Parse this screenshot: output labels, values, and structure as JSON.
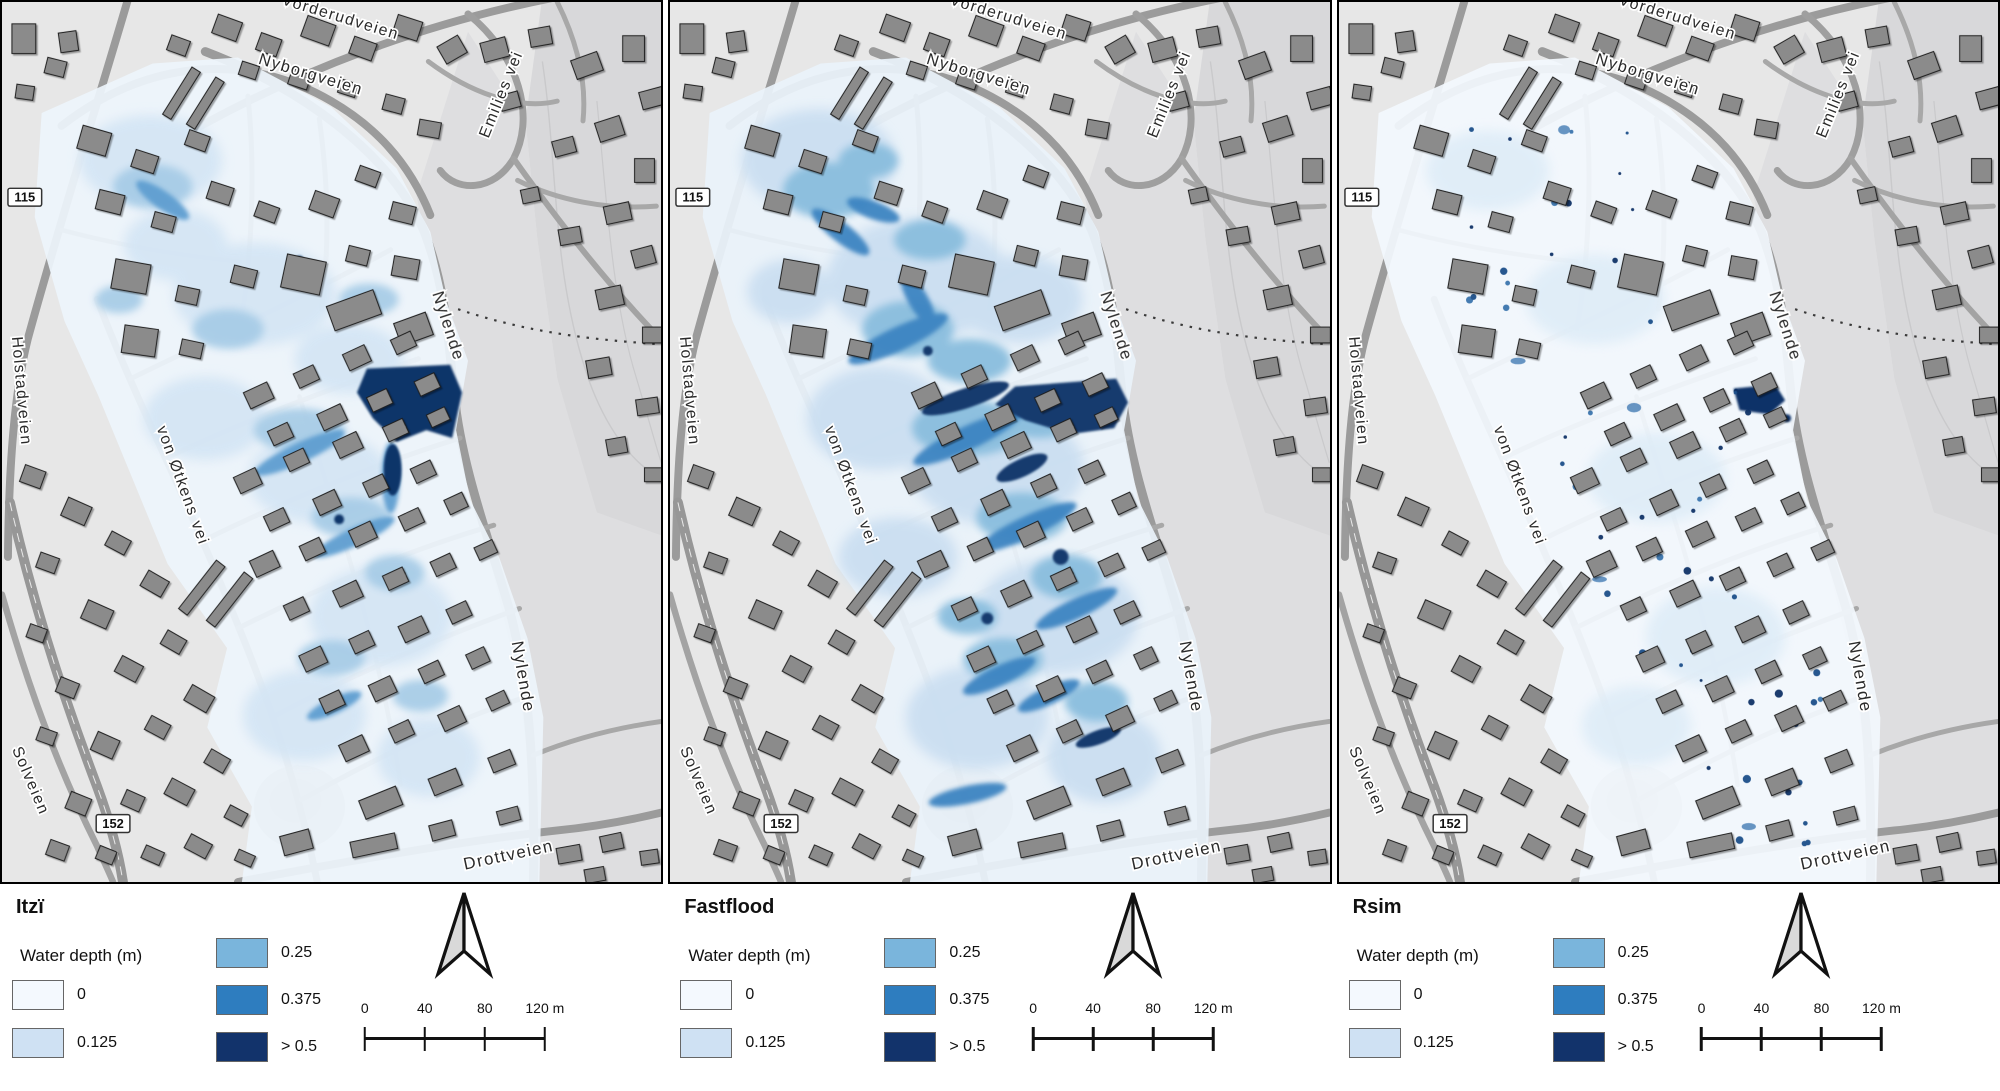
{
  "panels": [
    {
      "title": "Itzï"
    },
    {
      "title": "Fastflood"
    },
    {
      "title": "Rsim"
    }
  ],
  "legend": {
    "header": "Water depth (m)",
    "items": [
      {
        "label": "0",
        "color": "#f4f9fe"
      },
      {
        "label": "0.125",
        "color": "#cfe1f3"
      },
      {
        "label": "0.25",
        "color": "#7ab5dc"
      },
      {
        "label": "0.375",
        "color": "#2e7dbf"
      },
      {
        "label": "> 0.5",
        "color": "#12336b"
      }
    ]
  },
  "scalebar": {
    "labels": [
      "0",
      "40",
      "80",
      "120 m"
    ]
  },
  "icons": {
    "north_arrow": "north-arrow-icon"
  },
  "map_labels": {
    "street_vorderudveien": "Vorderudveien",
    "street_nyborgveien": "Nyborgveien",
    "street_emilies_vei": "Emilies vei",
    "street_holstadveien": "Holstadveien",
    "street_von_otkens_vei": "von Øtkens vei",
    "street_solveien": "Solveien",
    "street_nylende_upper": "Nylende",
    "street_nylende_lower": "Nylende",
    "street_drottveien": "Drottveien",
    "route_badge_115": "115",
    "route_badge_152": "152"
  },
  "basemap_colors": {
    "land": "#e7e7e7",
    "field": "#d9d9db",
    "road": "#9b9b9b",
    "building": "#8b8b8b"
  }
}
